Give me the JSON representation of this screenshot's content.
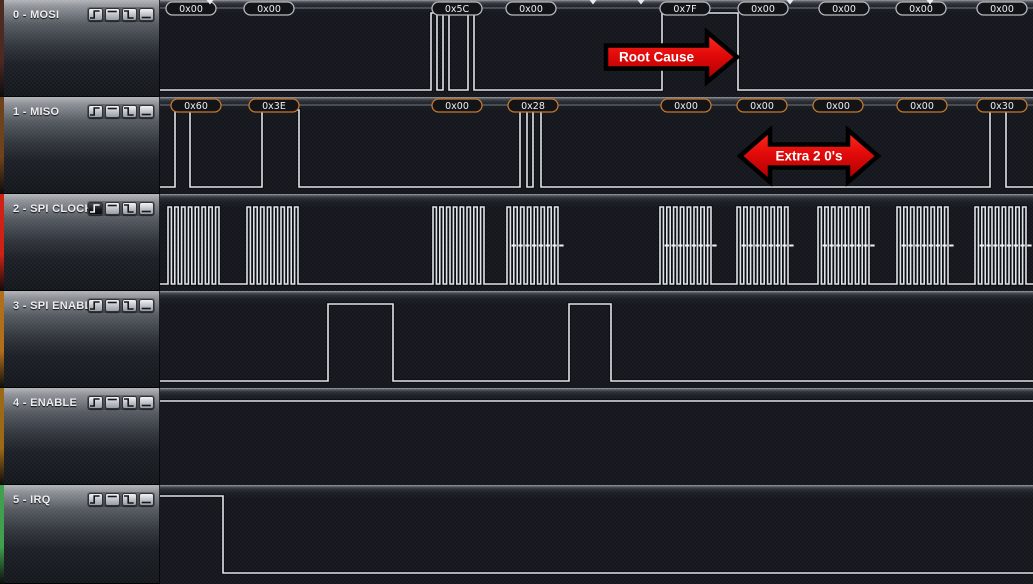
{
  "app": {
    "name": "logic-analyzer-capture"
  },
  "colors": {
    "wave": "#e0e4e8",
    "wave_shadow": "rgba(4,7,11,0.5)",
    "background": "#14171d",
    "annotation_line": "rgba(170,176,183,0.6)",
    "bubble_fill": "#131418",
    "bubble_text": "#eceff1",
    "clock_sample_mark": "#eef1f4",
    "arrow_fill_top": "#ff3020",
    "arrow_fill_bottom": "#a80000",
    "arrow_outline": "#000000",
    "arrow_text": "#ffffff",
    "tick": "#e8ebee"
  },
  "trigger_buttons": [
    {
      "name": "rising-edge",
      "glyph": "step-up"
    },
    {
      "name": "high-level",
      "glyph": "bar-high"
    },
    {
      "name": "falling-edge",
      "glyph": "step-down"
    },
    {
      "name": "low-level",
      "glyph": "bar-low"
    }
  ],
  "timeline_ticks": [
    210,
    593,
    641,
    790,
    930
  ],
  "channels": [
    {
      "label": "0 - MOSI",
      "stripe_color": "#4d2a22",
      "annotation_border": "#b6bac0",
      "pressed_trigger": null,
      "annotations": [
        {
          "x": 191,
          "text": "0x00"
        },
        {
          "x": 269,
          "text": "0x00"
        },
        {
          "x": 457,
          "text": "0x5C"
        },
        {
          "x": 531,
          "text": "0x00"
        },
        {
          "x": 685,
          "text": "0x7F"
        },
        {
          "x": 763,
          "text": "0x00"
        },
        {
          "x": 844,
          "text": "0x00"
        },
        {
          "x": 921,
          "text": "0x00"
        },
        {
          "x": 1002,
          "text": "0x00"
        }
      ],
      "wave": {
        "kind": "edges",
        "edges": [
          [
            160,
            0
          ],
          [
            431,
            1
          ],
          [
            437,
            0
          ],
          [
            443,
            1
          ],
          [
            449,
            0
          ],
          [
            468,
            1
          ],
          [
            474,
            0
          ],
          [
            662,
            1
          ],
          [
            738,
            0
          ]
        ]
      }
    },
    {
      "label": "1 - MISO",
      "stripe_color": "#6e431c",
      "annotation_border": "#c4782e",
      "pressed_trigger": null,
      "annotations": [
        {
          "x": 196,
          "text": "0x60"
        },
        {
          "x": 274,
          "text": "0x3E"
        },
        {
          "x": 457,
          "text": "0x00"
        },
        {
          "x": 533,
          "text": "0x28"
        },
        {
          "x": 686,
          "text": "0x00"
        },
        {
          "x": 762,
          "text": "0x00"
        },
        {
          "x": 838,
          "text": "0x00"
        },
        {
          "x": 922,
          "text": "0x00"
        },
        {
          "x": 1002,
          "text": "0x30"
        }
      ],
      "wave": {
        "kind": "edges",
        "edges": [
          [
            160,
            0
          ],
          [
            175,
            1
          ],
          [
            190,
            0
          ],
          [
            262,
            1
          ],
          [
            299,
            0
          ],
          [
            520,
            1
          ],
          [
            527,
            0
          ],
          [
            533,
            1
          ],
          [
            541,
            0
          ],
          [
            990,
            1
          ],
          [
            1006,
            0
          ]
        ]
      }
    },
    {
      "label": "2 - SPI CLOCK",
      "stripe_color": "#cf2214",
      "annotation_border": null,
      "pressed_trigger": 0,
      "annotations": [],
      "wave": {
        "kind": "clock",
        "cycles": 8,
        "period": 6.8,
        "bursts": [
          {
            "start": 168,
            "dashes": false
          },
          {
            "start": 247,
            "dashes": false
          },
          {
            "start": 433,
            "dashes": false
          },
          {
            "start": 507,
            "dashes": true
          },
          {
            "start": 660,
            "dashes": true
          },
          {
            "start": 737,
            "dashes": true
          },
          {
            "start": 818,
            "dashes": true
          },
          {
            "start": 897,
            "dashes": true
          },
          {
            "start": 975,
            "dashes": true
          }
        ]
      }
    },
    {
      "label": "3 - SPI ENABLE",
      "stripe_color": "#b06f1a",
      "annotation_border": null,
      "pressed_trigger": null,
      "annotations": [],
      "wave": {
        "kind": "edges",
        "edges": [
          [
            160,
            0
          ],
          [
            328,
            1
          ],
          [
            393,
            0
          ],
          [
            569,
            1
          ],
          [
            611,
            0
          ]
        ]
      }
    },
    {
      "label": "4 - ENABLE",
      "stripe_color": "#9c6a16",
      "annotation_border": null,
      "pressed_trigger": null,
      "annotations": [],
      "wave": {
        "kind": "edges",
        "edges": [
          [
            160,
            1
          ]
        ]
      }
    },
    {
      "label": "5 - IRQ",
      "stripe_color": "#41a04e",
      "annotation_border": null,
      "pressed_trigger": null,
      "annotations": [],
      "wave": {
        "kind": "edges",
        "edges": [
          [
            160,
            1
          ],
          [
            223,
            0
          ]
        ]
      }
    }
  ],
  "arrows": [
    {
      "type": "right",
      "label": "Root Cause",
      "x1": 606,
      "x2": 737,
      "cy": 57,
      "body_h": 23,
      "head_w": 30,
      "head_h": 50
    },
    {
      "type": "double",
      "label": "Extra 2 0's",
      "x1": 740,
      "x2": 878,
      "cy": 156,
      "body_h": 23,
      "head_w": 30,
      "head_h": 52
    }
  ]
}
